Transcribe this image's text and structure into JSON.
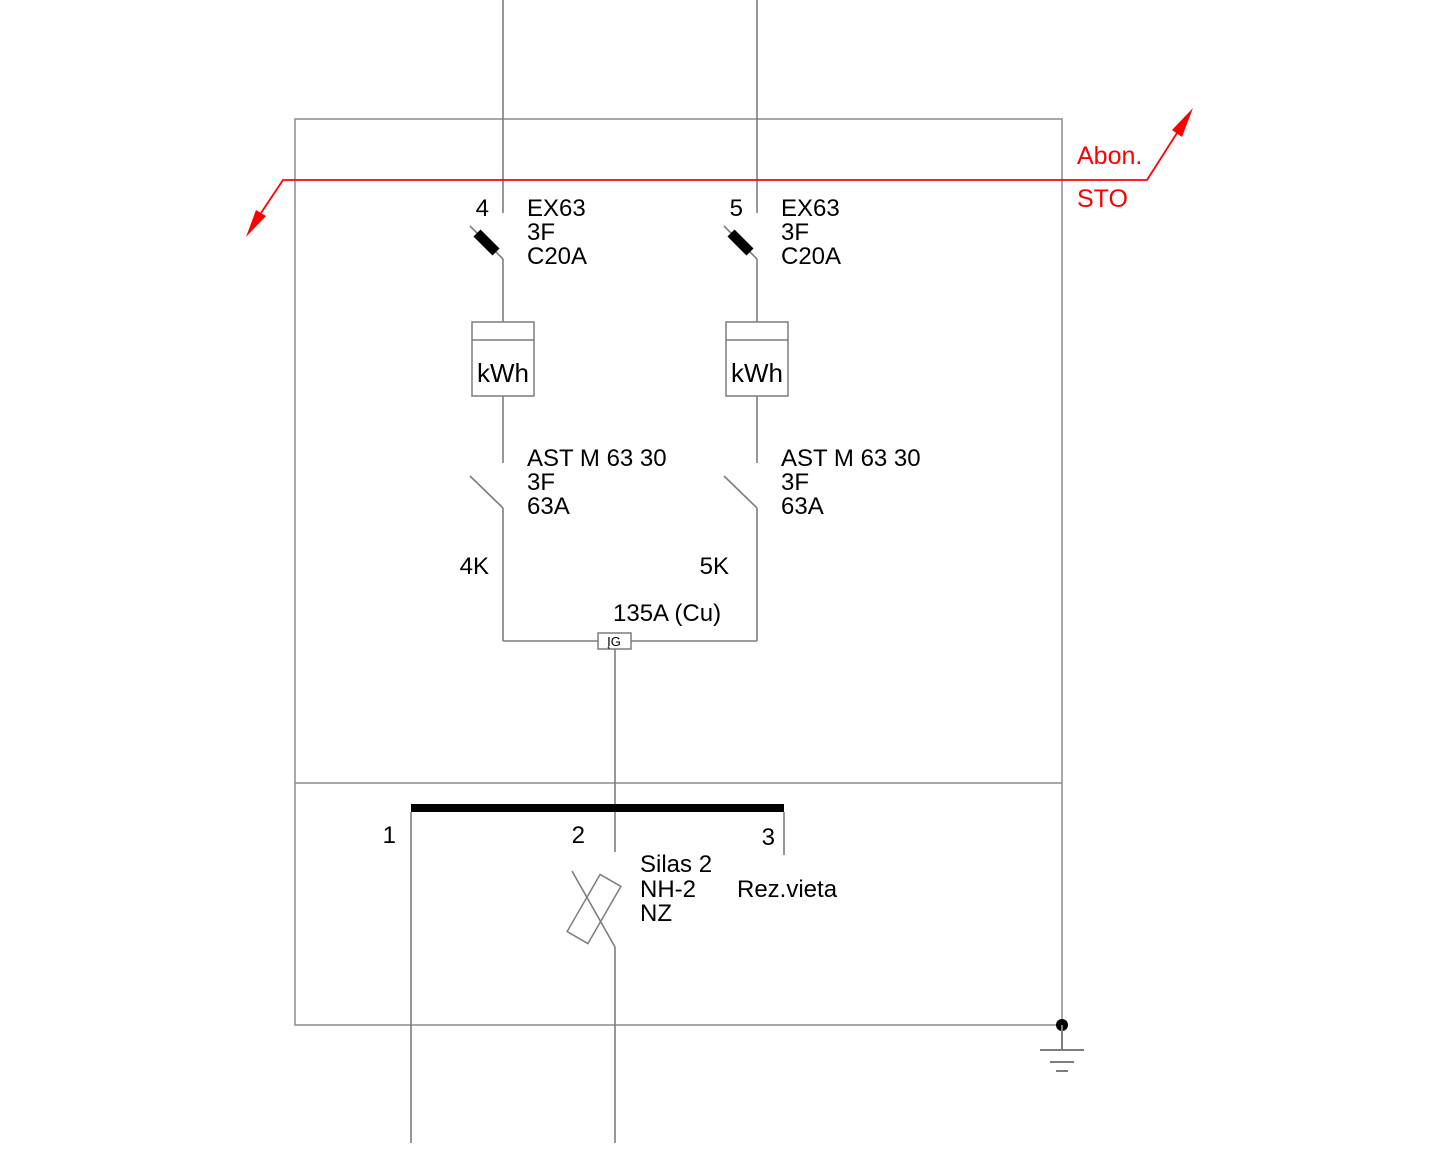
{
  "colors": {
    "accent_red": "#ff0000",
    "line_gray": "#7d7d7d",
    "ink_black": "#000000",
    "background": "#ffffff"
  },
  "feeder": {
    "above_label": "Abon.",
    "below_label": "STO"
  },
  "branches": [
    {
      "number": "4",
      "breaker_model": "EX63",
      "breaker_phases": "3F",
      "breaker_rating": "C20A",
      "meter_label": "kWh",
      "switch_model": "AST M 63 30",
      "switch_phases": "3F",
      "switch_rating": "63A",
      "cable_tag": "4K"
    },
    {
      "number": "5",
      "breaker_model": "EX63",
      "breaker_phases": "3F",
      "breaker_rating": "C20A",
      "meter_label": "kWh",
      "switch_model": "AST M 63 30",
      "switch_phases": "3F",
      "switch_rating": "63A",
      "cable_tag": "5K"
    }
  ],
  "junction": {
    "rating_label": "135A (Cu)",
    "device_label": "ĮG"
  },
  "busbar": {
    "taps": [
      {
        "number": "1"
      },
      {
        "number": "2"
      },
      {
        "number": "3"
      }
    ],
    "reserve_note": "Rez.vieta"
  },
  "fuse": {
    "name": "Silas 2",
    "type": "NH-2",
    "size": "NZ"
  }
}
